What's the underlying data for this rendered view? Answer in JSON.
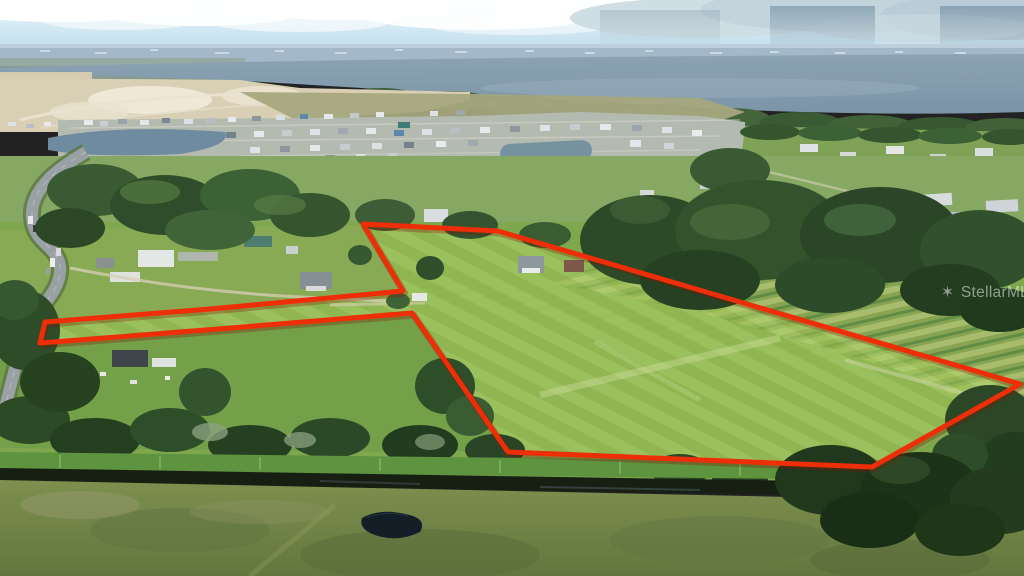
{
  "meta": {
    "type": "aerial-drone-real-estate-photo",
    "description": "Aerial drone photo of rural Florida acreage outlined with a red property-boundary overlay; lake, new housing development and highway in the background, pasture and drainage ditch in the foreground",
    "width": 1024,
    "height": 576
  },
  "watermark": {
    "text": "StellarMLS",
    "star": "✶",
    "color": "#ffffff"
  },
  "boundary": {
    "points": "45,322 210,309 403,291 363,224 498,231 1020,384 872,467 508,452 412,313 218,329 40,343",
    "color": "#ee2e08",
    "shadow_color": "#7d1400",
    "stroke_width": 5
  },
  "scene": {
    "colors": {
      "sky_top": "#eaf7fb",
      "sky_bottom": "#b5d7e8",
      "cloud": "#ffffff",
      "rain_shaft": "#7d96a8",
      "distant_city": "#a3b9c9",
      "lake": "#879fb1",
      "sand_development": "#d9cfb5",
      "olive_field": "#a7a87e",
      "pasture": "#7fa84e",
      "pasture_inside_boundary": "#a8cc5a",
      "crop_row_light": "#a9bd6e",
      "crop_row_dark": "#5f8a42",
      "tree_dark": "#2c4a27",
      "tree_mid": "#3a5c33",
      "reeds": "#5e9340",
      "ditch_water": "#171f12",
      "foreground_pasture": "#78894b",
      "pond": "#131e26",
      "road": "#99a1a5",
      "subdivision_base": "#b3bab0",
      "retention_pond": "#6f8ba0"
    }
  }
}
